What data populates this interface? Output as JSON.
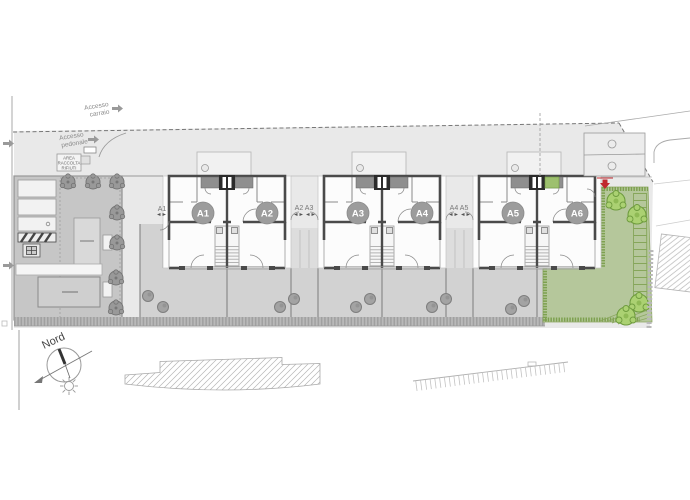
{
  "site_plan": {
    "access": {
      "carraio_line1": "Accesso",
      "carraio_line2": "carraio",
      "pedonale_line1": "Accesso",
      "pedonale_line2": "pedonale"
    },
    "waste_area": {
      "line1": "AREA",
      "line2": "RACCOLTA",
      "line3": "RIFIUTI"
    },
    "compass": {
      "north": "Nord"
    },
    "units": [
      {
        "id": "A1"
      },
      {
        "id": "A2"
      },
      {
        "id": "A3"
      },
      {
        "id": "A4"
      },
      {
        "id": "A5"
      },
      {
        "id": "A6"
      }
    ],
    "entrance_labels": {
      "a1": "A1",
      "a2_a3": "A2 A3",
      "a4_a5": "A4 A5",
      "a6": "A6"
    },
    "highlighted_unit": "A6",
    "colors": {
      "accent_red": "#c0272d",
      "garden_green": "#b5c79b",
      "hedge_green": "#7da04f",
      "tree_green": "#abd172",
      "wall_dark": "#4a4a4a",
      "paving_light": "#e9e9e9",
      "parking_gray": "#c6c6c6",
      "garden_gray": "#d2d2d2"
    }
  }
}
